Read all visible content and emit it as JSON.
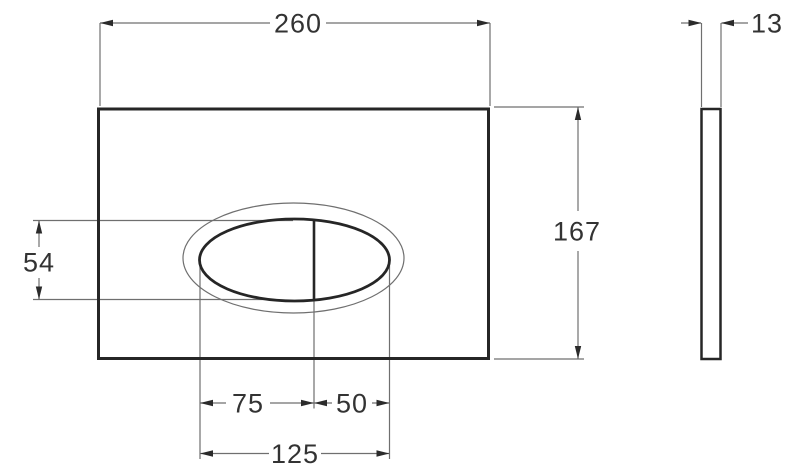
{
  "colors": {
    "thin_line": "#6f6f6f",
    "thick_line": "#262626",
    "arrow": "#2b2b2b",
    "text": "#333333",
    "background": "#ffffff"
  },
  "dimensions": {
    "overall_width": "260",
    "overall_height": "167",
    "thickness": "13",
    "button_opening_height": "54",
    "large_button_width": "75",
    "small_button_width": "50",
    "button_opening_width": "125"
  }
}
